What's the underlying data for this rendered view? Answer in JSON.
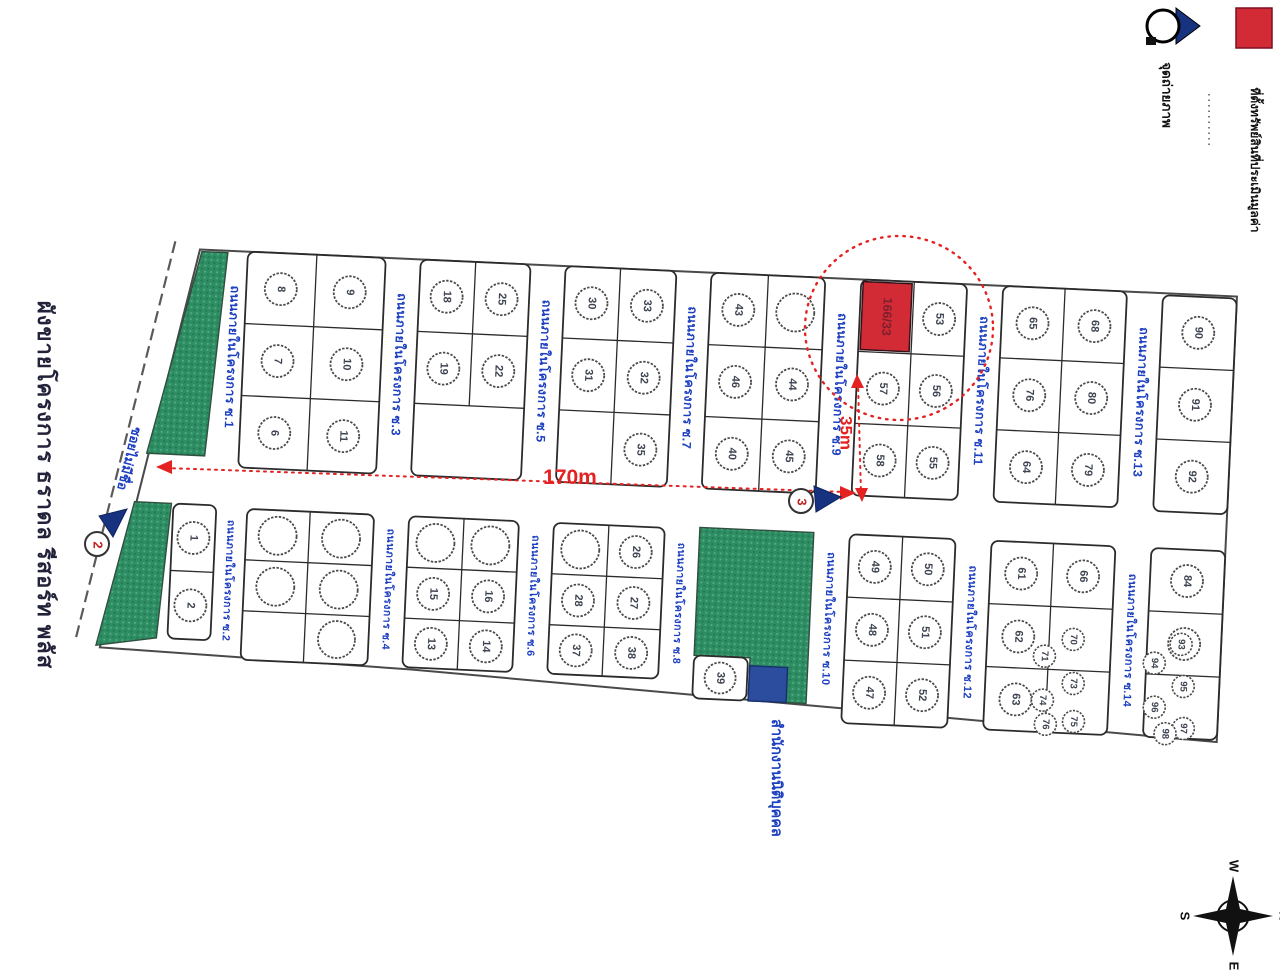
{
  "title": "ผังขายโครงการ ธราดล รีสอร์ท พลัส",
  "legend": {
    "camera_label": "จุดถ่ายภาพ",
    "red_label": "ที่ตั้งทรัพย์สินที่ประเมินมูลค่า"
  },
  "dimensions": {
    "width": "170m",
    "depth": "35m"
  },
  "compass": {
    "top": "W",
    "right": "N",
    "bottom": "E",
    "left": "S"
  },
  "colors": {
    "green": "#2e8e63",
    "red": "#d22b35",
    "red_dim": "#e42222",
    "blue": "#2c4d9d",
    "road_text": "#1c3fc0",
    "ink": "#2b2b2b",
    "number": "#3d4350",
    "subject_text": "#7d1f2e"
  },
  "map": {
    "outer_road_label": "ซอยไม่มีชื่อ",
    "office_label": "สำนักงานนิติบุคคล",
    "subject_plot_number": "166/33",
    "photo_markers": [
      "2",
      "3"
    ],
    "green_areas": [
      "202,252 228,252 214,456 156,456",
      "146,505 183,505 174,640 114,650",
      "712,505 826,505 826,676 768,676 768,633 712,633"
    ],
    "roads": [
      {
        "label": "ถนนภายในโครงการ ซ.1",
        "x": 236,
        "y1": 252,
        "y2": 460,
        "fs": 12.5
      },
      {
        "label": "ถนนภายในโครงการ ซ.3",
        "x": 403,
        "y1": 252,
        "y2": 460,
        "fs": 12.5
      },
      {
        "label": "ถนนภายในโครงการ ซ.5",
        "x": 548,
        "y1": 252,
        "y2": 460,
        "fs": 12.5
      },
      {
        "label": "ถนนภายในโครงการ ซ.7",
        "x": 694,
        "y1": 252,
        "y2": 460,
        "fs": 12.5
      },
      {
        "label": "ถนนภายในโครงการ ซ.9",
        "x": 844,
        "y1": 252,
        "y2": 460,
        "fs": 12.5
      },
      {
        "label": "ถนนภายในโครงการ ซ.11",
        "x": 986,
        "y1": 252,
        "y2": 460,
        "fs": 12.5
      },
      {
        "label": "ถนนภายในโครงการ ซ.13",
        "x": 1146,
        "y1": 254,
        "y2": 466,
        "fs": 12.5
      },
      {
        "label": "ถนนภายในโครงการ ซ.2",
        "x": 243,
        "y1": 507,
        "y2": 652,
        "fs": 10.5
      },
      {
        "label": "ถนนภายในโครงการ ซ.4",
        "x": 403,
        "y1": 507,
        "y2": 655,
        "fs": 10.5
      },
      {
        "label": "ถนนภายในโครงการ ซ.6",
        "x": 548,
        "y1": 507,
        "y2": 655,
        "fs": 10.5
      },
      {
        "label": "ถนนภายในโครงการ ซ.8",
        "x": 694,
        "y1": 507,
        "y2": 657,
        "fs": 10.5
      },
      {
        "label": "ถนนภายในโครงการ ซ.10",
        "x": 844,
        "y1": 505,
        "y2": 676,
        "fs": 11
      },
      {
        "label": "ถนนภายในโครงการ ซ.12",
        "x": 986,
        "y1": 505,
        "y2": 690,
        "fs": 11
      },
      {
        "label": "ถนนภายในโครงการ ซ.14",
        "x": 1146,
        "y1": 505,
        "y2": 692,
        "fs": 11
      }
    ],
    "blocks": [
      {
        "x1": 248,
        "x2": 386,
        "split": 317,
        "rows": [
          250,
          322,
          394,
          466
        ],
        "cells": [
          [
            "8",
            "9"
          ],
          [
            "7",
            "10"
          ],
          [
            "6",
            "11"
          ]
        ]
      },
      {
        "x1": 421,
        "x2": 531,
        "split": 476,
        "rows": [
          250,
          322,
          394,
          466
        ],
        "cells": [
          [
            "18",
            "25"
          ],
          [
            "19",
            "22"
          ],
          [
            null
          ]
        ],
        "fullRows": [
          2
        ]
      },
      {
        "x1": 566,
        "x2": 677,
        "split": 621,
        "rows": [
          250,
          322,
          394,
          466
        ],
        "cells": [
          [
            "30",
            "33"
          ],
          [
            "31",
            "32"
          ],
          [
            null,
            "35"
          ]
        ]
      },
      {
        "x1": 712,
        "x2": 826,
        "split": 769,
        "rows": [
          250,
          322,
          394,
          466
        ],
        "cells": [
          [
            "43",
            ""
          ],
          [
            "46",
            "44"
          ],
          [
            "40",
            "45"
          ]
        ]
      },
      {
        "x1": 862,
        "x2": 968,
        "split": 915,
        "rows": [
          250,
          322,
          394,
          466
        ],
        "cells": [
          [
            "RED",
            "53"
          ],
          [
            "57",
            "56"
          ],
          [
            "58",
            "55"
          ]
        ]
      },
      {
        "x1": 1004,
        "x2": 1128,
        "split": 1066,
        "rows": [
          250,
          322,
          394,
          466
        ],
        "cells": [
          [
            "65",
            "68"
          ],
          [
            "76",
            "80"
          ],
          [
            "64",
            "79"
          ]
        ]
      },
      {
        "x1": 1164,
        "x2": 1238,
        "split": null,
        "rows": [
          252,
          324,
          396,
          468
        ],
        "cells": [
          [
            "90"
          ],
          [
            "91"
          ],
          [
            "92"
          ]
        ]
      },
      {
        "x1": 185,
        "x2": 228,
        "split": null,
        "rows": [
          505,
          572,
          640
        ],
        "cells": [
          [
            "1"
          ],
          [
            "2"
          ]
        ]
      },
      {
        "x1": 259,
        "x2": 386,
        "split": 322,
        "rows": [
          507,
          558,
          609,
          658
        ],
        "cells": [
          [
            "",
            ""
          ],
          [
            "",
            ""
          ],
          [
            null,
            ""
          ]
        ]
      },
      {
        "x1": 421,
        "x2": 531,
        "split": 476,
        "rows": [
          507,
          558,
          609,
          658
        ],
        "cells": [
          [
            "",
            ""
          ],
          [
            "15",
            "16"
          ],
          [
            "13",
            "14"
          ]
        ]
      },
      {
        "x1": 566,
        "x2": 677,
        "split": 621,
        "rows": [
          507,
          558,
          609,
          658
        ],
        "cells": [
          [
            "",
            "26"
          ],
          [
            "28",
            "27"
          ],
          [
            "37",
            "38"
          ]
        ]
      },
      {
        "x1": 712,
        "x2": 766,
        "split": null,
        "rows": [
          633,
          676
        ],
        "cells": [
          [
            "39"
          ]
        ]
      },
      {
        "x1": 862,
        "x2": 968,
        "split": 915,
        "rows": [
          505,
          568,
          631,
          694
        ],
        "cells": [
          [
            "49",
            "50"
          ],
          [
            "48",
            "51"
          ],
          [
            "47",
            "52"
          ]
        ]
      },
      {
        "x1": 1004,
        "x2": 1128,
        "split": 1066,
        "rows": [
          505,
          568,
          631,
          694
        ],
        "cells": [
          [
            "61",
            "66"
          ],
          [
            "62",
            null
          ],
          [
            "63",
            null
          ]
        ],
        "smalls": [
          [
            1090,
            600,
            "70"
          ],
          [
            1062,
            618,
            "71"
          ],
          [
            1092,
            644,
            "73"
          ],
          [
            1062,
            662,
            "74"
          ],
          [
            1094,
            682,
            "75"
          ],
          [
            1066,
            686,
            "76"
          ]
        ]
      },
      {
        "x1": 1164,
        "x2": 1238,
        "split": null,
        "rows": [
          505,
          568,
          631,
          694
        ],
        "cells": [
          [
            "84"
          ],
          [
            "85"
          ],
          [
            null
          ]
        ],
        "smalls": [
          [
            1198,
            600,
            "93"
          ],
          [
            1172,
            620,
            "94"
          ],
          [
            1202,
            642,
            "95"
          ],
          [
            1174,
            664,
            "96"
          ],
          [
            1204,
            684,
            "97"
          ],
          [
            1186,
            690,
            "98"
          ]
        ]
      }
    ]
  }
}
